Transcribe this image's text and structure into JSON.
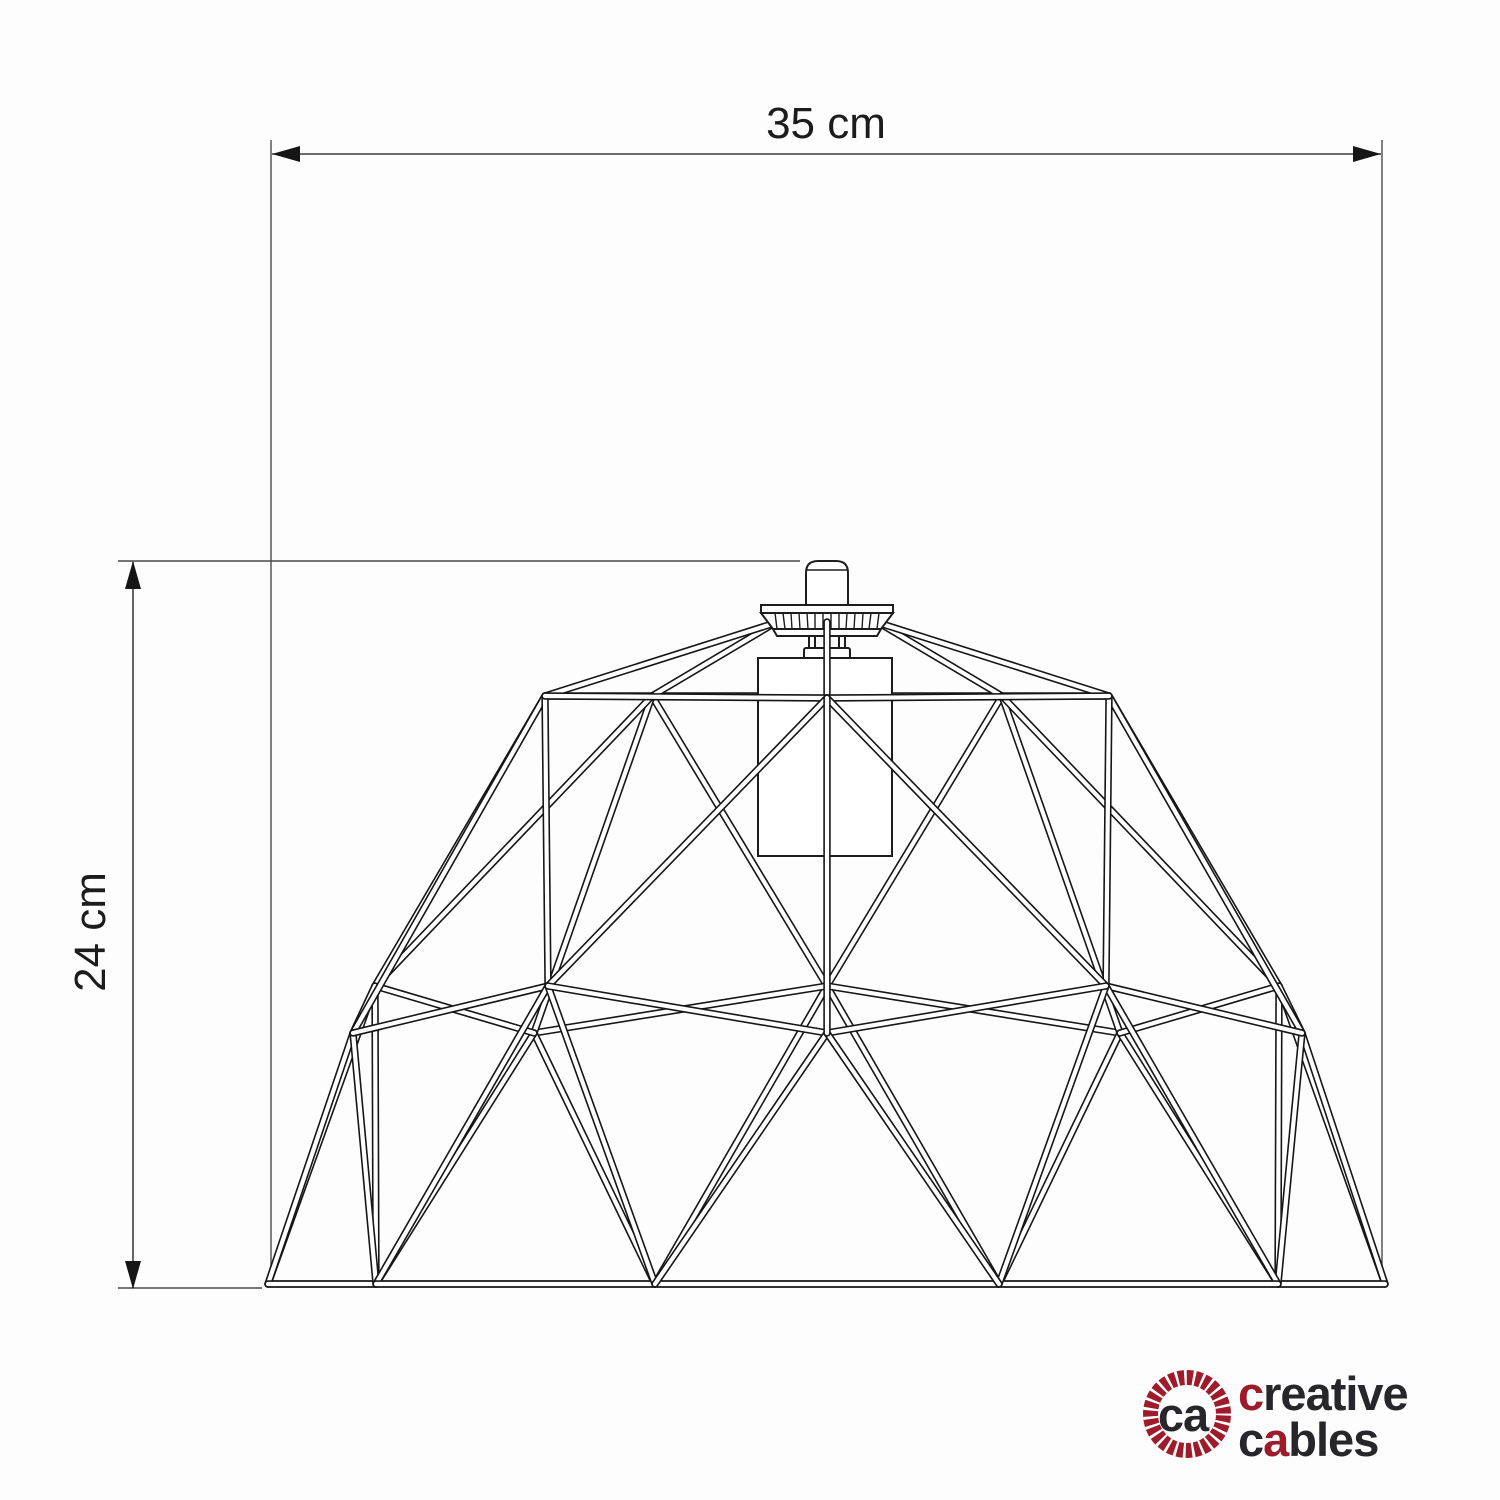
{
  "diagram": {
    "width_label": "35 cm",
    "height_label": "24 cm"
  },
  "logo": {
    "monogram": "ca",
    "word1_accent": "c",
    "word1_rest": "reative",
    "word2_start": "c",
    "word2_accent": "a",
    "word2_rest": "bles"
  },
  "colors": {
    "accent_red": "#9e1b2b",
    "ink": "#27272b",
    "line": "#1a1a1a"
  }
}
